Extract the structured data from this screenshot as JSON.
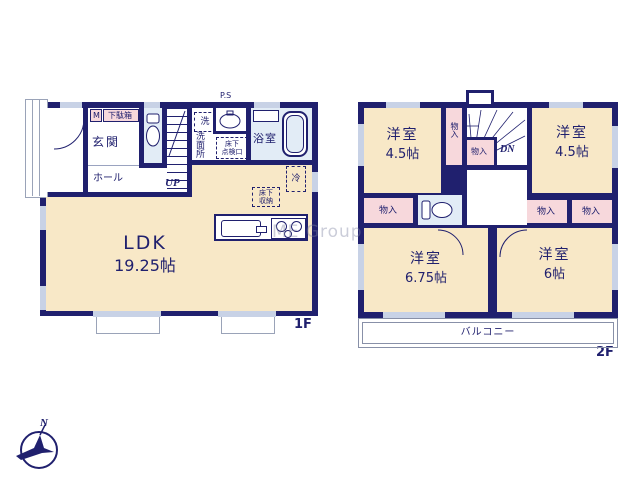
{
  "watermark": "ME Group",
  "compass": {
    "north": "N"
  },
  "colors": {
    "wall": "#20206e",
    "room_cream": "#f8e8c7",
    "closet_pink": "#f7d8dc",
    "wet_area_blue": "#e2ecf6",
    "window_gray": "#c8d2e6",
    "text_navy": "#20206e"
  },
  "floor1": {
    "label": "1F",
    "entrance": "玄関",
    "hall": "ホール",
    "meter_box": "M",
    "shoe_box": "下駄箱",
    "stairs_up": "UP",
    "pipe_space": "P.S",
    "washer": "洗",
    "washroom": "洗面所",
    "underfloor_hatch_l1": "床下",
    "underfloor_hatch_l2": "点検口",
    "bathroom": "浴室",
    "fridge": "冷",
    "underfloor_storage_l1": "床下",
    "underfloor_storage_l2": "収納",
    "ldk_name": "LDK",
    "ldk_size": "19.25帖"
  },
  "floor2": {
    "label": "2F",
    "stairs_down": "DN",
    "closet": "物入",
    "balcony": "バルコニー",
    "room_nw": {
      "name": "洋室",
      "size": "4.5帖"
    },
    "room_ne": {
      "name": "洋室",
      "size": "4.5帖"
    },
    "room_sw": {
      "name": "洋室",
      "size": "6.75帖"
    },
    "room_se": {
      "name": "洋室",
      "size": "6帖"
    }
  }
}
